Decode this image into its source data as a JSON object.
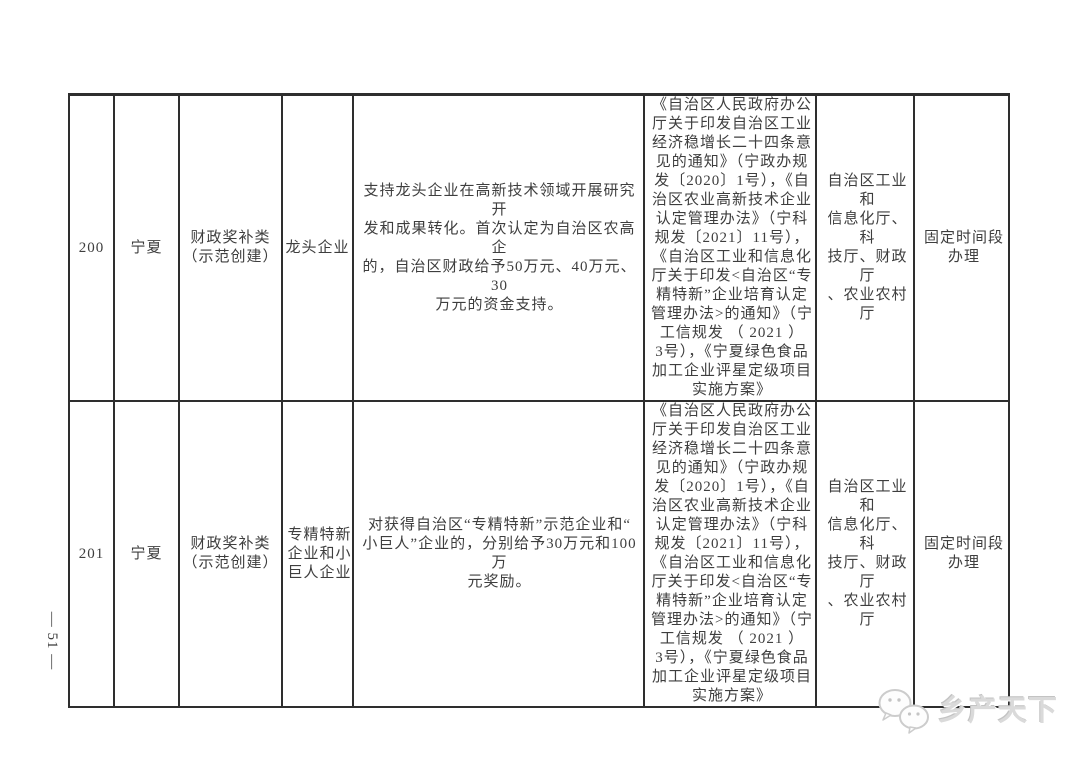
{
  "page": {
    "page_number": "— 51 —",
    "watermark": {
      "icon": "chat-bubbles-icon",
      "text": "乡产天下",
      "color": "#cfcfcf"
    }
  },
  "table": {
    "border_color": "#2e2e2e",
    "rows": [
      {
        "id": "200",
        "region": "宁夏",
        "policy_type": "财政奖补类\n（示范创建）",
        "target": "龙头企业",
        "support": "支持龙头企业在高新技术领域开展研究开\n发和成果转化。首次认定为自治区农高企\n的，自治区财政给予50万元、40万元、30\n万元的资金支持。",
        "basis": "《自治区人民政府办公\n厅关于印发自治区工业\n经济稳增长二十四条意\n见的通知》（宁政办规\n发〔2020〕1号），《自\n治区农业高新技术企业\n认定管理办法》（宁科\n规发〔2021〕11号），\n《自治区工业和信息化\n厅关于印发<自治区“专\n精特新”企业培育认定\n管理办法>的通知》（宁\n工信规发 （ 2021 ）\n3号），《宁夏绿色食品\n加工企业评星定级项目\n实施方案》",
        "department": "自治区工业和\n信息化厅、科\n技厅、财政厅\n、农业农村厅",
        "timing": "固定时间段\n办理"
      },
      {
        "id": "201",
        "region": "宁夏",
        "policy_type": "财政奖补类\n（示范创建）",
        "target": "专精特新\n企业和小\n巨人企业",
        "support": "对获得自治区“专精特新”示范企业和“\n小巨人”企业的，分别给予30万元和100万\n元奖励。",
        "basis": "《自治区人民政府办公\n厅关于印发自治区工业\n经济稳增长二十四条意\n见的通知》（宁政办规\n发〔2020〕1号），《自\n治区农业高新技术企业\n认定管理办法》（宁科\n规发〔2021〕11号），\n《自治区工业和信息化\n厅关于印发<自治区“专\n精特新”企业培育认定\n管理办法>的通知》（宁\n工信规发 （ 2021 ）\n3号），《宁夏绿色食品\n加工企业评星定级项目\n实施方案》",
        "department": "自治区工业和\n信息化厅、科\n技厅、财政厅\n、农业农村厅",
        "timing": "固定时间段\n办理"
      }
    ]
  }
}
